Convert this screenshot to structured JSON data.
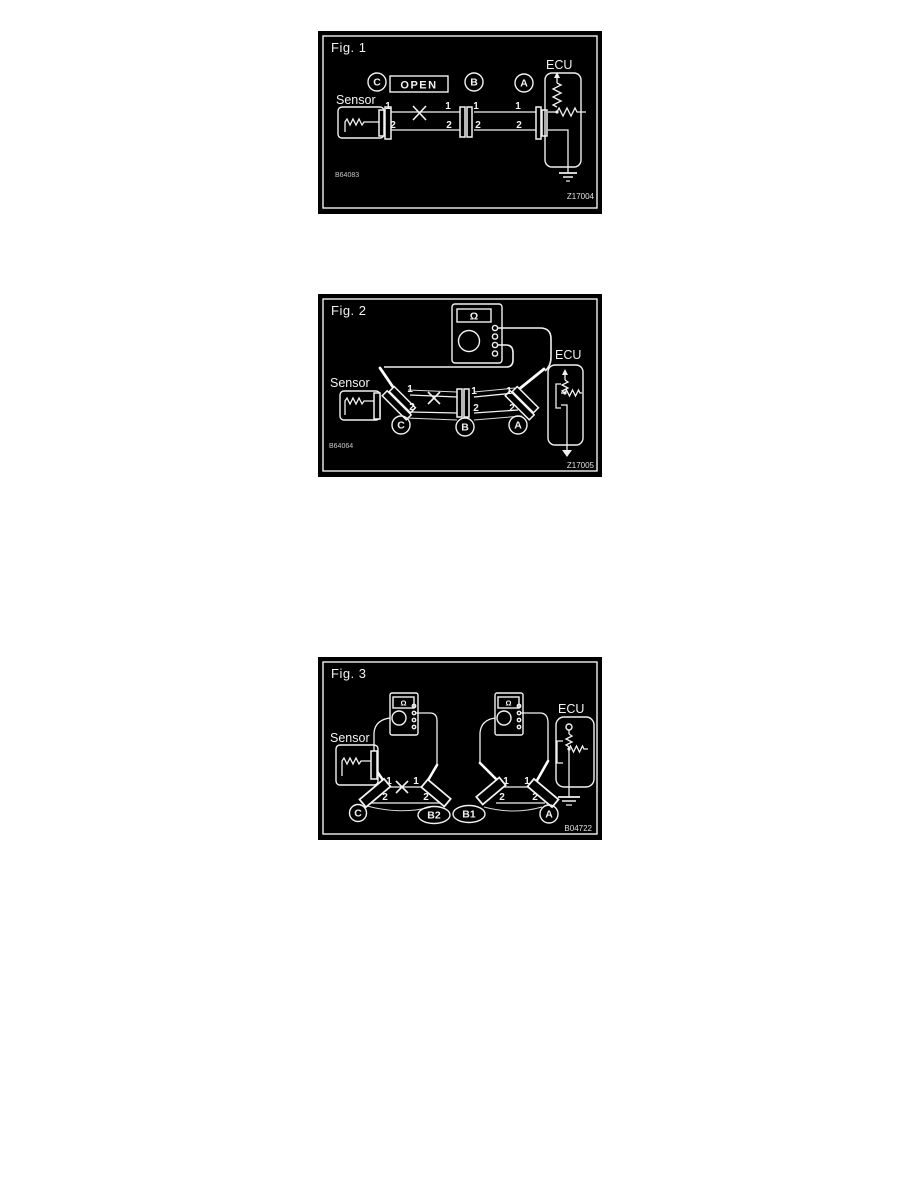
{
  "page": {
    "background": "#ffffff",
    "figure_background": "#000000",
    "line_color": "#f2f2f2"
  },
  "fig1": {
    "title": "Fig. 1",
    "ecu": "ECU",
    "sensor": "Sensor",
    "open_box": "OPEN",
    "conn_c": "C",
    "conn_b": "B",
    "conn_a": "A",
    "pin1": "1",
    "pin2": "2",
    "code": "B64083",
    "ref": "Z17004"
  },
  "fig2": {
    "title": "Fig. 2",
    "ecu": "ECU",
    "sensor": "Sensor",
    "ohm": "Ω",
    "conn_c": "C",
    "conn_b": "B",
    "conn_a": "A",
    "pin1": "1",
    "pin2": "2",
    "code": "B64064",
    "ref": "Z17005"
  },
  "fig3": {
    "title": "Fig. 3",
    "ecu": "ECU",
    "sensor": "Sensor",
    "ohm": "Ω",
    "conn_c": "C",
    "conn_b2": "B2",
    "conn_b1": "B1",
    "conn_a": "A",
    "pin1": "1",
    "pin2": "2",
    "ref": "B04722"
  }
}
